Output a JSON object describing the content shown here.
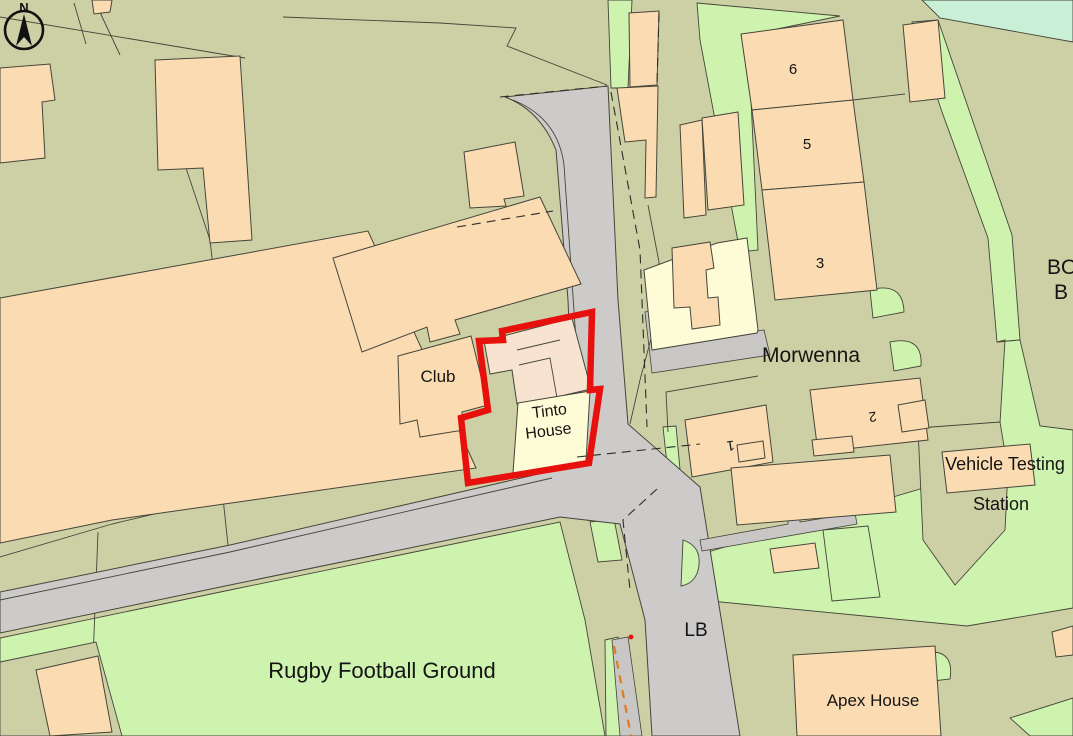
{
  "map": {
    "type": "ordnance-survey-style site location plan",
    "labels": {
      "north": "N",
      "club": "Club",
      "tinto_line1": "Tinto",
      "tinto_line2": "House",
      "morwenna": "Morwenna",
      "unit6": "6",
      "unit5": "5",
      "unit3": "3",
      "unit2": "2",
      "unit1": "1",
      "vehicle_testing_line1": "Vehicle Testing",
      "vehicle_testing_line2": "Station",
      "lb": "LB",
      "rugby": "Rugby Football Ground",
      "apex": "Apex House",
      "edge_text_line1": "BO",
      "edge_text_line2": "B"
    },
    "colors": {
      "background_olive": "#cdd0a5",
      "building_peach": "#fbdcb2",
      "building_pale": "#f7e3cf",
      "building_yellow": "#fdfcd6",
      "grass_green": "#cdf3ae",
      "mint_green": "#c9efd6",
      "road_grey": "#cccbca",
      "boundary_red": "#e8100c",
      "line_dark": "#45453a",
      "unfenced_orange": "#e07b20"
    },
    "selection": {
      "subject_property": "Tinto House",
      "outline_style": "thick red polygon"
    }
  }
}
